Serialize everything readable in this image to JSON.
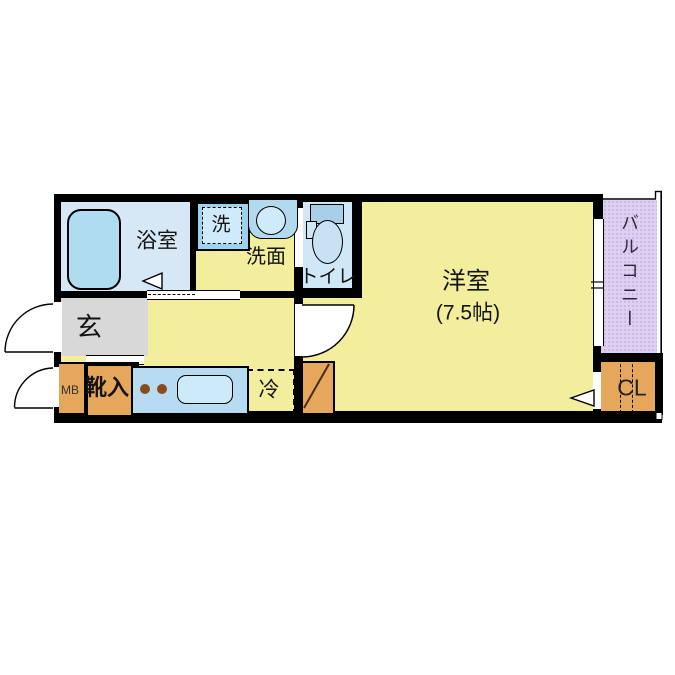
{
  "floorplan": {
    "title": "1K apartment floor plan",
    "rooms": {
      "bathroom": {
        "label": "浴室"
      },
      "laundry": {
        "label": "洗"
      },
      "washroom": {
        "label": "洗面"
      },
      "toilet": {
        "label": "トイレ"
      },
      "western_room": {
        "label": "洋室",
        "size": "(7.5帖)"
      },
      "genkan": {
        "label": "玄"
      },
      "shoe_box": {
        "label": "靴入"
      },
      "meter_box": {
        "label": "MB"
      },
      "refrigerator": {
        "label": "冷"
      },
      "balcony": {
        "label": "バルコニー"
      },
      "closet": {
        "label": "CL"
      }
    },
    "colors": {
      "room_yellow": "#f2ee9e",
      "bath_blue": "#d6e8f6",
      "fixture_blue": "#b0dcf2",
      "toilet_blue": "#cfe7f6",
      "genkan_gray": "#d8d8d8",
      "storage_orange": "#e5a75c",
      "balcony_purple": "#ddd0f2",
      "wall_black": "#000000",
      "burner_brown": "#8a4a1e"
    }
  }
}
